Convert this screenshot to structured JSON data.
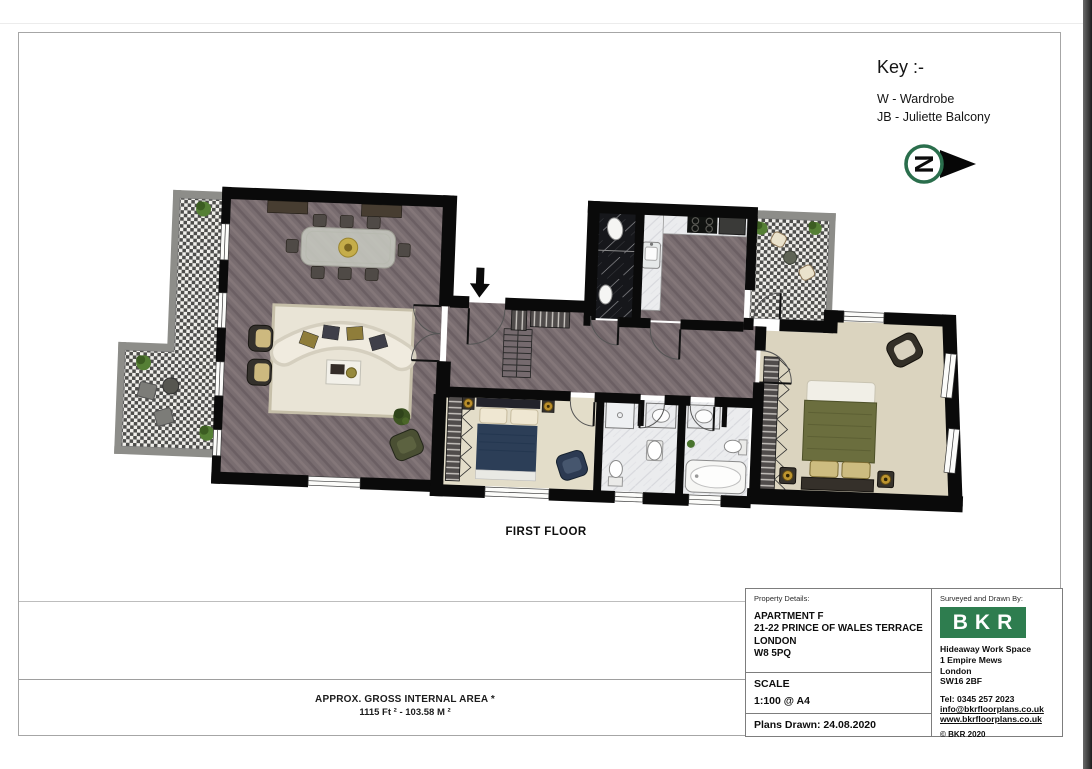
{
  "page": {
    "floor_label": "FIRST FLOOR"
  },
  "key": {
    "title": "Key :-",
    "items": [
      "W  -  Wardrobe",
      "JB - Juliette Balcony"
    ]
  },
  "north_arrow": {
    "letter": "N"
  },
  "area": {
    "line1": "APPROX. GROSS INTERNAL AREA *",
    "line2": "1115 Ft ²  -  103.58 M ²"
  },
  "property": {
    "label": "Property Details:",
    "address": [
      "APARTMENT F",
      "21-22 PRINCE OF WALES TERRACE",
      "LONDON",
      "W8 5PQ"
    ],
    "scale_label": "SCALE",
    "scale_value": "1:100 @ A4",
    "plans_drawn": "Plans Drawn: 24.08.2020"
  },
  "surveyor": {
    "label": "Surveyed and Drawn By:",
    "logo": "BKR",
    "address": [
      "Hideaway Work Space",
      "1 Empire Mews",
      "London",
      "SW16 2BF"
    ],
    "tel": "Tel:  0345 257 2023",
    "email": "info@bkrfloorplans.co.uk",
    "website": "www.bkrfloorplans.co.uk",
    "copyright": "©  BKR 2020"
  },
  "colors": {
    "accent_green": "#2e7d4f",
    "wall_black": "#0a0a0a",
    "floor_herringbone": "#796d70",
    "carpet": "#ded8c4",
    "rug": "#e9e4d6"
  }
}
